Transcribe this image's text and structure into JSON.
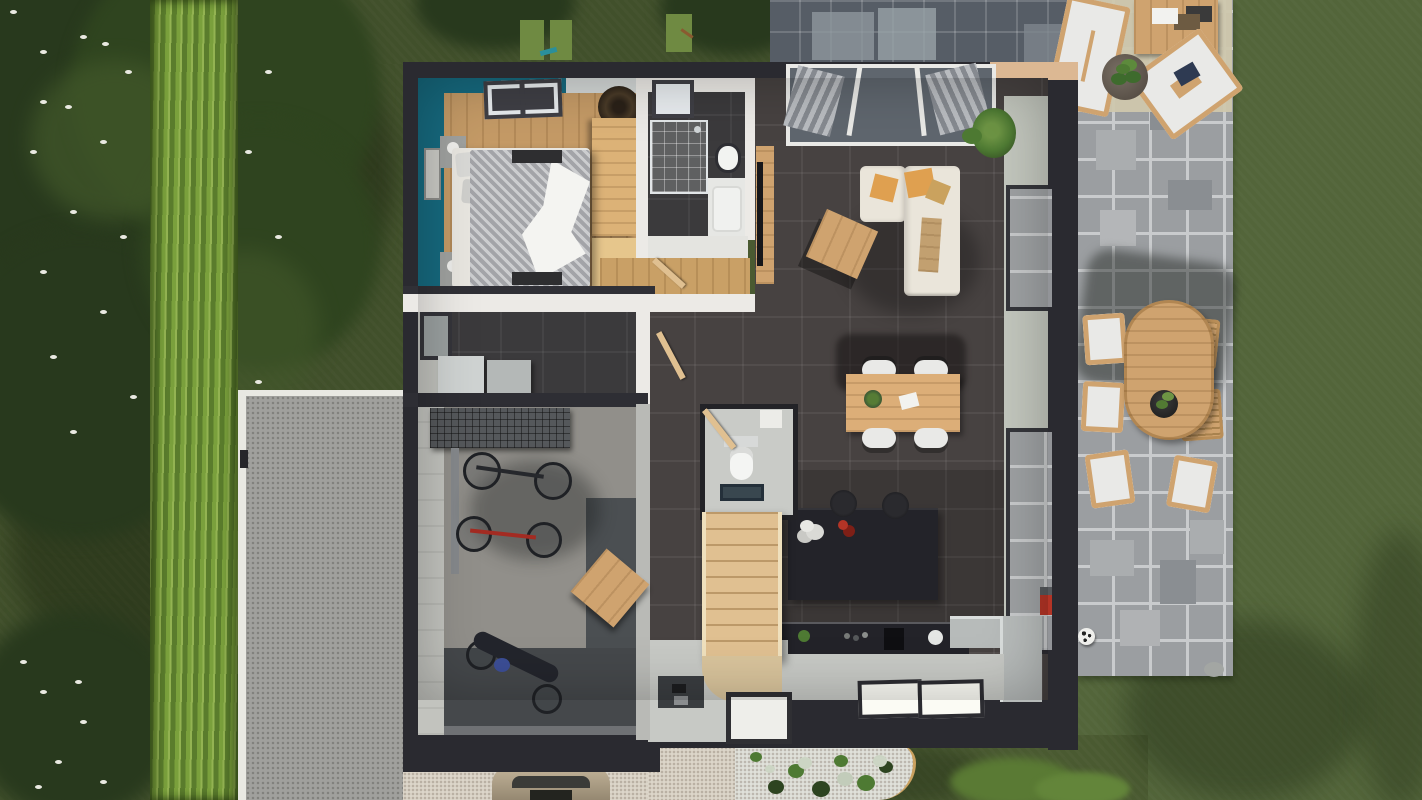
{
  "scene": {
    "title": "Top-down 3D rendering of a house floor plan with garden, hedge, driveway and stone patios",
    "rooms": [
      {
        "name": "bedroom",
        "accent_wall": "teal",
        "floor": "light wood",
        "furniture": [
          "double-bed",
          "wardrobe",
          "dresser",
          "nightstands",
          "roof-window",
          "pendant-lamp",
          "wall-picture"
        ]
      },
      {
        "name": "bathroom",
        "floor": "dark tile",
        "furniture": [
          "walk-in-shower",
          "shower-tray",
          "roof-window",
          "washbasin"
        ]
      },
      {
        "name": "living-room",
        "floor": "dark tile",
        "furniture": [
          "corner-sofa",
          "coffee-table",
          "tv-sideboard",
          "bay-window",
          "potted-plant"
        ]
      },
      {
        "name": "dining-area",
        "floor": "dark tile",
        "furniture": [
          "wooden-dining-table",
          "white-chairs-x4"
        ]
      },
      {
        "name": "kitchen",
        "floor": "dark tile / light screed",
        "furniture": [
          "island-with-stools",
          "worktop-run",
          "window-bench",
          "roof-windows-x2"
        ]
      },
      {
        "name": "wc",
        "furniture": [
          "toilet",
          "corner-shelf",
          "mat"
        ]
      },
      {
        "name": "hall-stairs",
        "furniture": [
          "wooden-staircase",
          "doormat",
          "shoe-mat"
        ]
      },
      {
        "name": "utility-room",
        "floor": "dark tile",
        "furniture": [
          "washer",
          "dryer",
          "side-window"
        ]
      },
      {
        "name": "garage",
        "floor": "concrete",
        "furniture": [
          "wire-shelving",
          "bike-rack",
          "bicycle-black",
          "bicycle-red",
          "motorcycle",
          "pallet-table"
        ]
      }
    ],
    "outdoor": {
      "left": [
        "flowering-trees",
        "hedge-row",
        "lawn"
      ],
      "driveway": "grey tarmac with white curb",
      "front": [
        "gravel-apron",
        "parked-car-roof",
        "white-gravel-planting-bed"
      ],
      "right_patio": [
        "stone-pavers",
        "oval-dining-table",
        "garden-chairs-x6",
        "lounge-chairs-x2",
        "outdoor-rug",
        "coffee-table",
        "potted-plant",
        "football"
      ],
      "top_patio": [
        "dark-stone-pavers"
      ]
    },
    "colors": {
      "grass": "#4a5a31",
      "grassDark": "#41502b",
      "grassLight": "#53653a",
      "canopy": "#28391d",
      "canopyMid": "#2f441f",
      "canopyLight": "#42582a",
      "flower": "#e9e9e1",
      "hedge": "#7aa03c",
      "hedgeDark": "#5a7c2c",
      "hedgeLight": "#93b352",
      "curb": "#e8e8e2",
      "drive": "#a0a09d",
      "gravel": "#dcd6ca",
      "paver": "#9b9ea1",
      "paverLine": "#c9cbcd",
      "paverDeep": "#565d66",
      "wall": "#2a2a30",
      "wallWhite": "#eceae6",
      "wallFace": "#c3c7be",
      "woodFloor": "#c49a66",
      "wood": "#cfa36f",
      "woodLight": "#e0c091",
      "woodDark": "#a57a45",
      "teal": "#16697e",
      "darkFloor": "#474241",
      "darkFloor2": "#3b3a3c",
      "lightFloor": "#c7c9c5",
      "concrete": "#918f8a",
      "mat": "#484c4f",
      "counter": "#232329",
      "sofa": "#eae5da",
      "cushion": "#dfa050",
      "chairWhite": "#e9e9e7",
      "plant": "#4e7a33",
      "plantDark": "#2d4420",
      "rug": "#cfc7ad",
      "moto": "#3c4e96",
      "red": "#b33426",
      "glass": "#5f666e",
      "duvet": "#a3a4a8",
      "white": "#f2f2ef"
    }
  }
}
